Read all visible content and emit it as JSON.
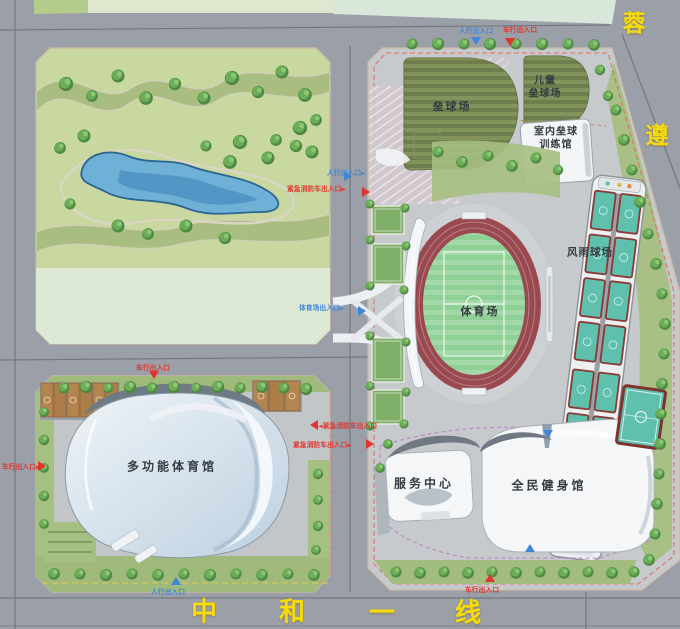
{
  "roads": {
    "right_name": "蓉遵",
    "right_chars": [
      "蓉",
      "遵"
    ],
    "bottom_name": "中和一线",
    "bottom_chars": [
      "中",
      "和",
      "一",
      "线"
    ]
  },
  "facilities": {
    "softball": "垒球场",
    "children_line1": "儿童",
    "children_line2": "垒球场",
    "indoor_line1": "室内垒球",
    "indoor_line2": "训练馆",
    "covered_courts": "风雨球场",
    "stadium": "体育场",
    "multi_gym": "多功能体育馆",
    "service_center": "服务中心",
    "fitness_hall": "全民健身馆"
  },
  "entrances": {
    "pedestrian": "人行出入口",
    "vehicle": "车行出入口",
    "emergency": "紧急消防车出入口",
    "stadium_gate": "体育场出入口"
  },
  "icons": {
    "arrow_right": "►",
    "arrow_left": "◄"
  },
  "colors": {
    "road_gray": "#9ba0a8",
    "parcel_gray": "#c6cacd",
    "park_green": "#c9d7a1",
    "band_green": "#a9bd81",
    "pale_green": "#dde9d4",
    "pond_blue": "#6fb0d6",
    "track_red": "#99494f",
    "pitch_green": "#8fd096",
    "court_teal": "#5fc0ae",
    "court_border": "#8a3a34",
    "field_olive": "#6e7e4d",
    "label_blue": "#3f86d8",
    "label_red": "#e2342e",
    "road_name_yellow": "#f7dc0a",
    "building_white": "#f4f6f7"
  }
}
